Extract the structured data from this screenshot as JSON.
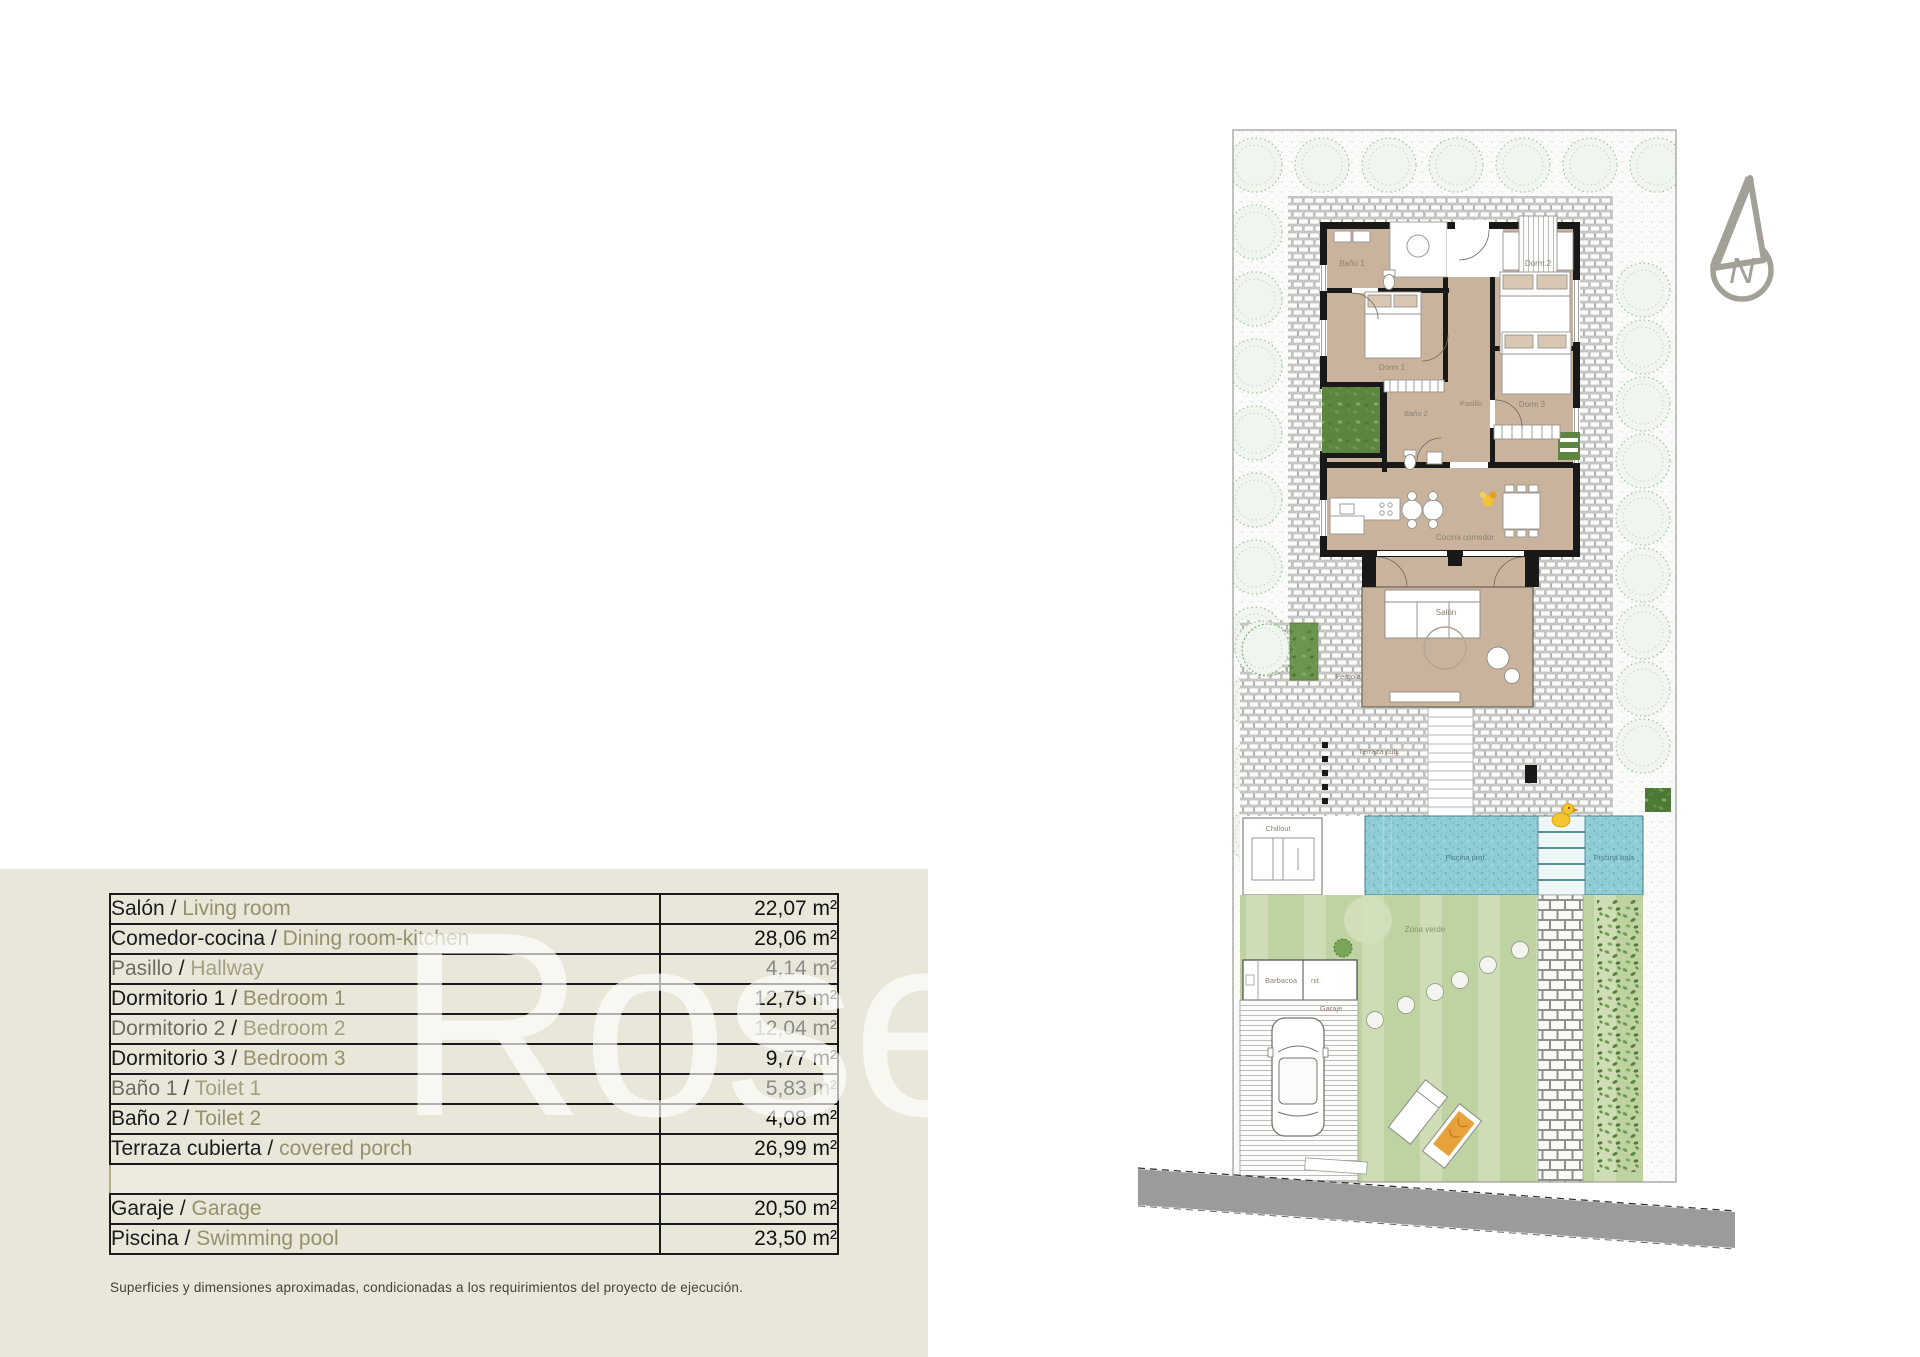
{
  "watermark": "Rosehill",
  "areas_table": {
    "rows": [
      {
        "label_es": "Salón",
        "label_en": "Living room",
        "value": "22,07 m²",
        "muted": false
      },
      {
        "label_es": "Comedor-cocina",
        "label_en": "Dining room-kitchen",
        "value": "28,06 m²",
        "muted": false
      },
      {
        "label_es": "Pasillo",
        "label_en": "Hallway",
        "value": "4,14 m²",
        "muted": true
      },
      {
        "label_es": "Dormitorio 1",
        "label_en": "Bedroom 1",
        "value": "12,75 m²",
        "muted": false
      },
      {
        "label_es": "Dormitorio 2",
        "label_en": "Bedroom 2",
        "value": "12,04 m²",
        "muted": true
      },
      {
        "label_es": "Dormitorio 3",
        "label_en": "Bedroom 3",
        "value": "9,77 m²",
        "muted": false
      },
      {
        "label_es": "Baño 1",
        "label_en": "Toilet 1",
        "value": "5,83 m²",
        "muted": true
      },
      {
        "label_es": "Baño 2",
        "label_en": "Toilet 2",
        "value": "4,08 m²",
        "muted": false
      },
      {
        "label_es": "Terraza cubierta",
        "label_en": "covered porch",
        "value": "26,99 m²",
        "muted": false
      },
      {
        "empty": true
      },
      {
        "label_es": "Garaje",
        "label_en": "Garage",
        "value": "20,50 m²",
        "muted": false
      },
      {
        "label_es": "Piscina",
        "label_en": "Swimming pool",
        "value": "23,50 m²",
        "muted": false
      }
    ],
    "separator": " / ",
    "footnote": "Superficies y dimensiones aproximadas, condicionadas a los requirimientos del proyecto de ejecución."
  },
  "floor_plan": {
    "labels": {
      "banyo1": "Baño 1",
      "dorm1": "Dorm 1",
      "dorm2": "Dorm.2",
      "banyo2": "Baño 2",
      "pasillo": "Pasillo",
      "dorm3": "Dorm 3",
      "cocina": "Cocina comedor",
      "salon": "Salón",
      "pergola": "Pérgola",
      "terraza": "Terraza cub.",
      "chillout": "Chillout",
      "piscina_prof": "Piscina prof.",
      "piscina_baja": "Piscina baja",
      "zona_verde": "Zona verde",
      "barbacoa": "Barbacoa",
      "barbacoa_unit": "nit.",
      "garaje": "Garaje",
      "north": "N"
    },
    "colors": {
      "room_fill": "#c9b39c",
      "wall": "#191919",
      "pool_water": "#90ccd5",
      "lawn": "#bfd2a2",
      "road": "#9b9b99",
      "duck_accent": "#f3c52f",
      "panel_beige": "#e9e6da",
      "label_brown": "#8d8273",
      "table_english_olive": "#96906c"
    }
  }
}
